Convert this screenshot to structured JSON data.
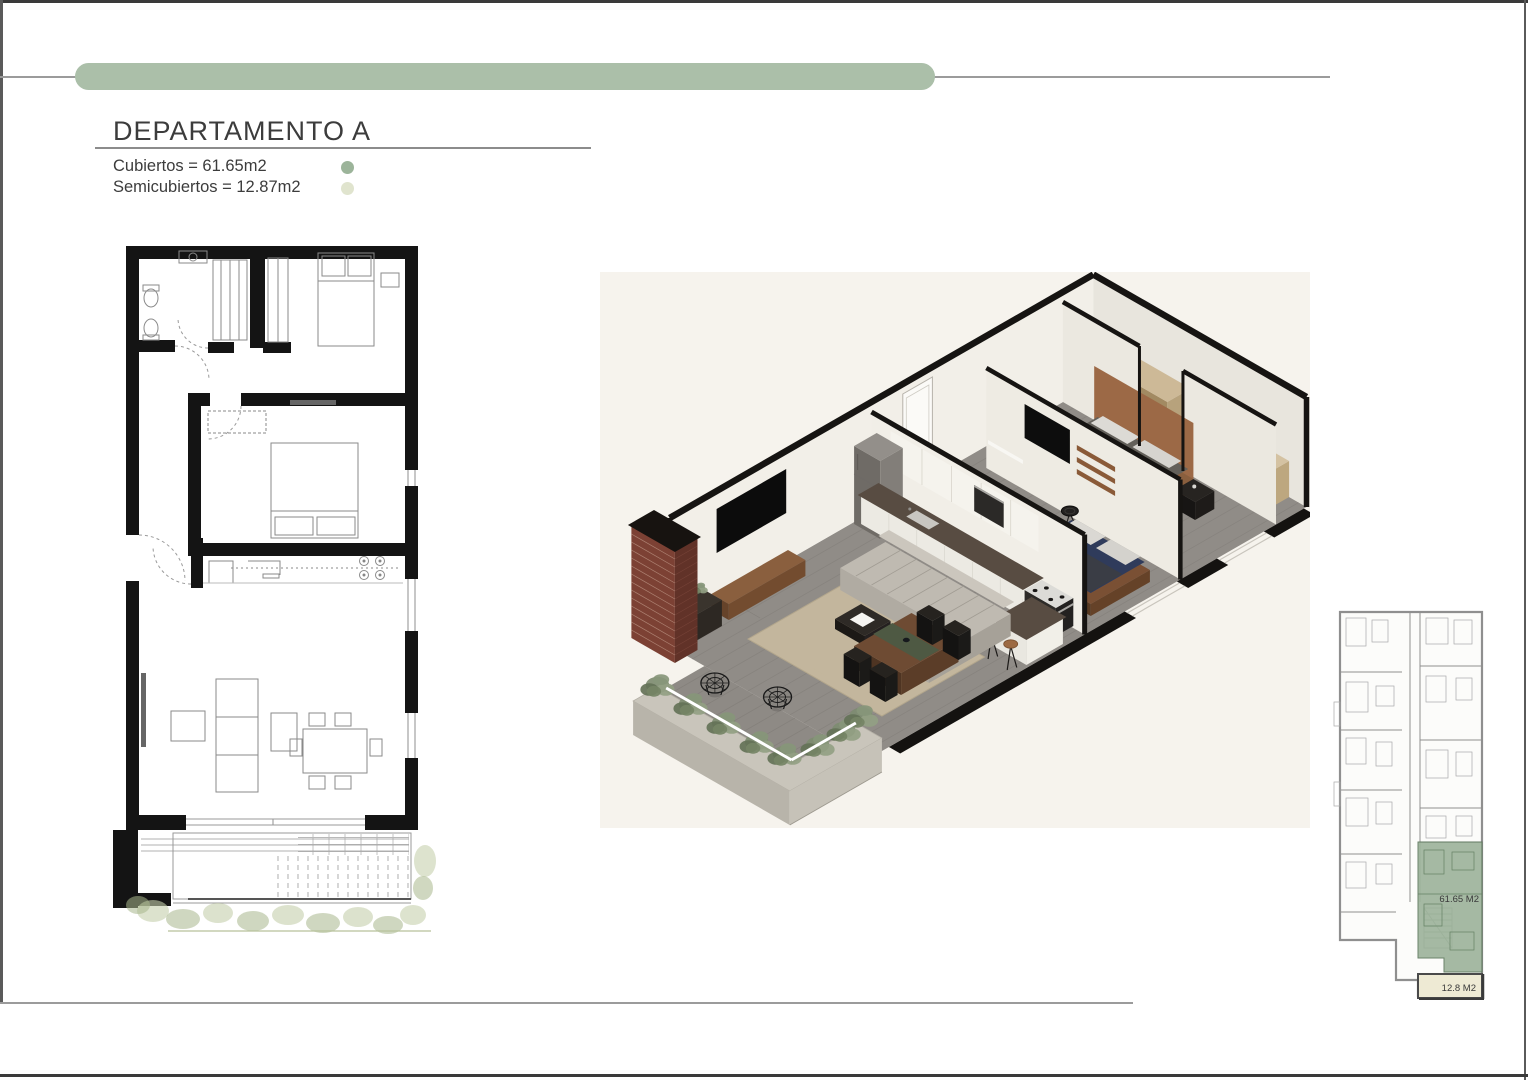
{
  "page": {
    "background": "#ffffff",
    "border_color": "#3a3a3a",
    "rule_color": "#9b9b9b"
  },
  "header": {
    "accent_bar_color": "#abbfa9"
  },
  "title": {
    "text": "DEPARTAMENTO A"
  },
  "legend": {
    "items": [
      {
        "label": "Cubiertos = 61.65m2",
        "dot_color": "#9cb49a"
      },
      {
        "label": "Semicubiertos = 12.87m2",
        "dot_color": "#e0e4ce"
      }
    ]
  },
  "keyplan": {
    "area_main": "61.65 M2",
    "area_semi": "12.8 M2",
    "highlight_color": "#9eb49c",
    "semi_fill": "#eeead4"
  }
}
